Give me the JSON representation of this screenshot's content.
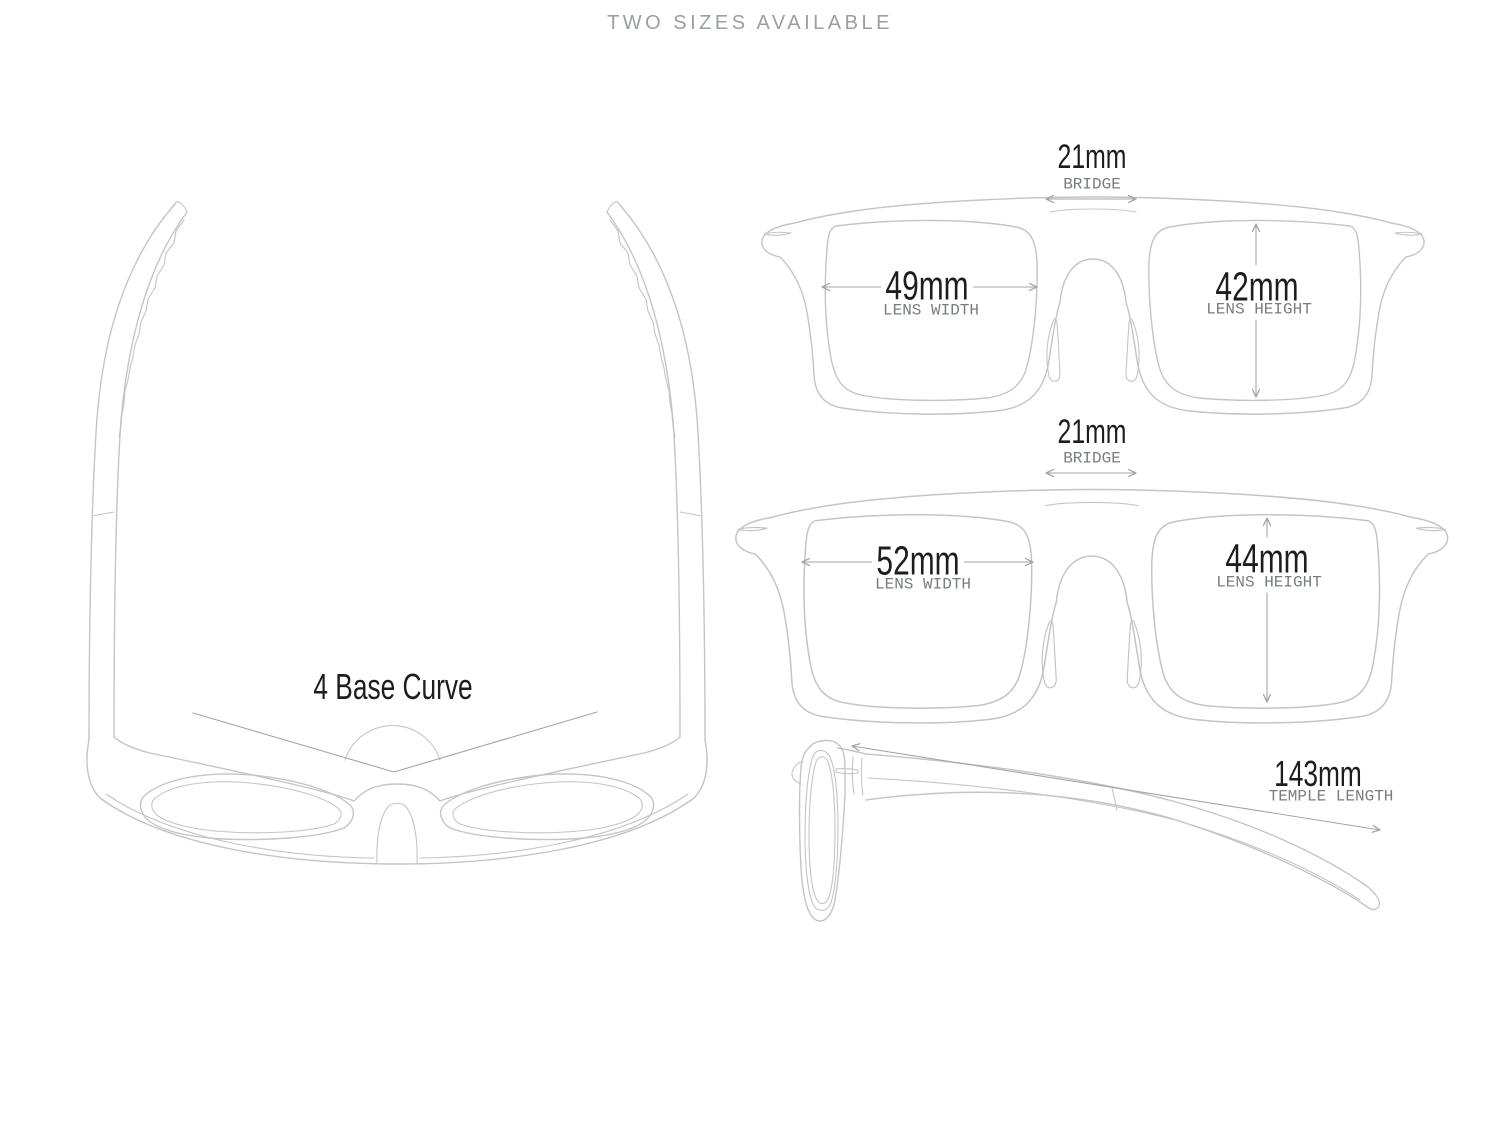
{
  "title": "TWO SIZES AVAILABLE",
  "colors": {
    "line": "#c3c5c5",
    "arrow": "#a3a6a6",
    "number": "#1d1d1d",
    "caption": "#797d7f",
    "title": "#9b9e9e"
  },
  "top_view": {
    "base_curve_label": "4 Base Curve"
  },
  "size_one": {
    "bridge_value": "21mm",
    "bridge_label": "BRIDGE",
    "lens_width_value": "49mm",
    "lens_width_label": "LENS WIDTH",
    "lens_height_value": "42mm",
    "lens_height_label": "LENS HEIGHT"
  },
  "size_two": {
    "bridge_value": "21mm",
    "bridge_label": "BRIDGE",
    "lens_width_value": "52mm",
    "lens_width_label": "LENS WIDTH",
    "lens_height_value": "44mm",
    "lens_height_label": "LENS HEIGHT"
  },
  "side_view": {
    "temple_length_value": "143mm",
    "temple_length_label": "TEMPLE LENGTH"
  }
}
